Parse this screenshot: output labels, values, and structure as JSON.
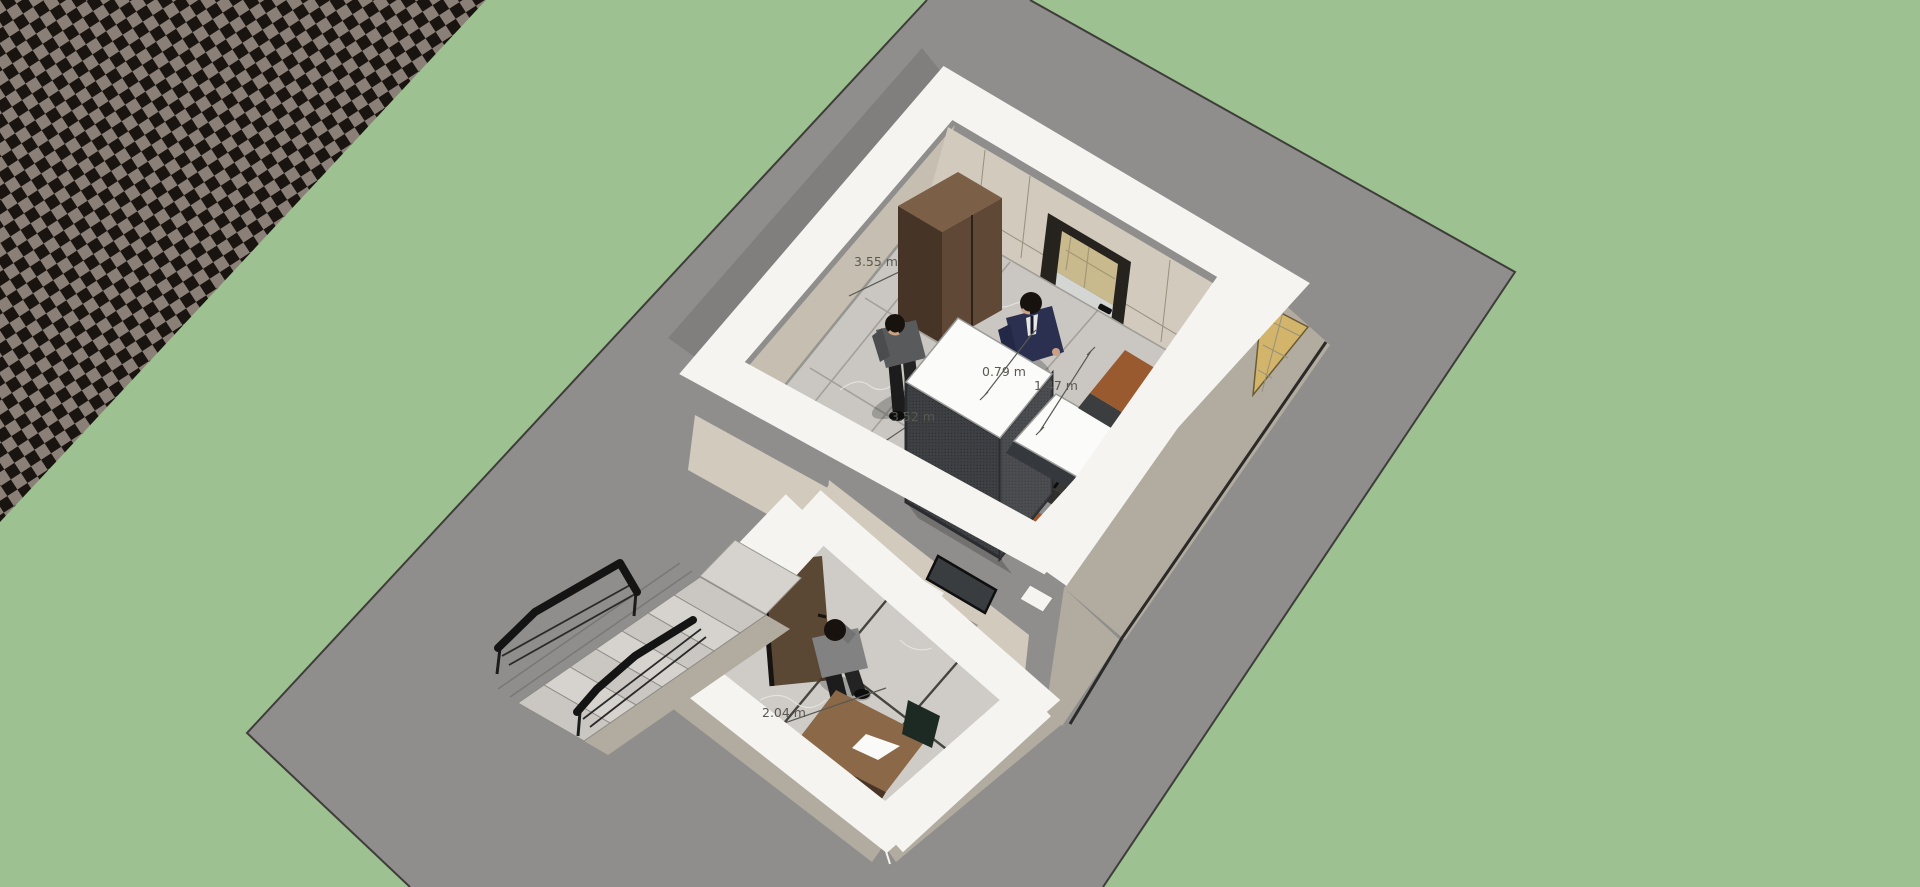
{
  "app": {
    "title": "3D architectural model viewport",
    "view": "top-down orbit view of a two-room unit on a gray ground slab"
  },
  "annotations": [
    {
      "id": "dim-wall-upper",
      "text": "3.55 m"
    },
    {
      "id": "dim-floor-upper",
      "text": "3.52 m"
    },
    {
      "id": "dim-cabinet-top",
      "text": "0.79 m"
    },
    {
      "id": "dim-floor-gap",
      "text": "1.47 m"
    },
    {
      "id": "dim-floor-lower",
      "text": "2.04 m"
    }
  ],
  "scene_objects": [
    "checkered backdrop plane",
    "green background",
    "gray ground slab",
    "upper room",
    "lower room",
    "wardrobe",
    "entry glass door",
    "open wooden door",
    "mesh cabinet with white top",
    "second mesh cabinet",
    "sienna side table",
    "slatted radiator",
    "wooden desk with paper sheet",
    "marble staircase",
    "black handrails",
    "man in navy suit",
    "man in gray suit",
    "man in gray jacket",
    "parquet balcony wedge"
  ],
  "palette": {
    "bg_green": "#9dc191",
    "ground_gray": "#908e8c",
    "edge_dark": "#3e3d3a",
    "checker_dark": "#1a1411",
    "checker_light": "#8b8078",
    "wall_white": "#f5f4f1",
    "wall_greige": "#b2aca0",
    "wall_beige": "#d1cabd",
    "wall_beige_dark": "#c6bfb1",
    "floor_marble": "#cac7c2",
    "floor_marble_lower": "#cfccc7",
    "wood_floor": "#d2b56b",
    "wardrobe_front": "#5f4836",
    "wardrobe_side": "#463527",
    "wardrobe_top": "#7b5f46",
    "door_leaf": "#5a4734",
    "door_frame": "#26231f",
    "glass_tan": "#c9ba8e",
    "glass_light": "#d4d6d3",
    "mesh_dark": "#3e4044",
    "sienna": "#9a5a30",
    "navy_suit": "#2b3050",
    "gray_suit": "#585a5c",
    "gray_jacket": "#828282",
    "desk_wood": "#8a6848",
    "rail_black": "#141414",
    "label_gray": "#5a5852"
  }
}
